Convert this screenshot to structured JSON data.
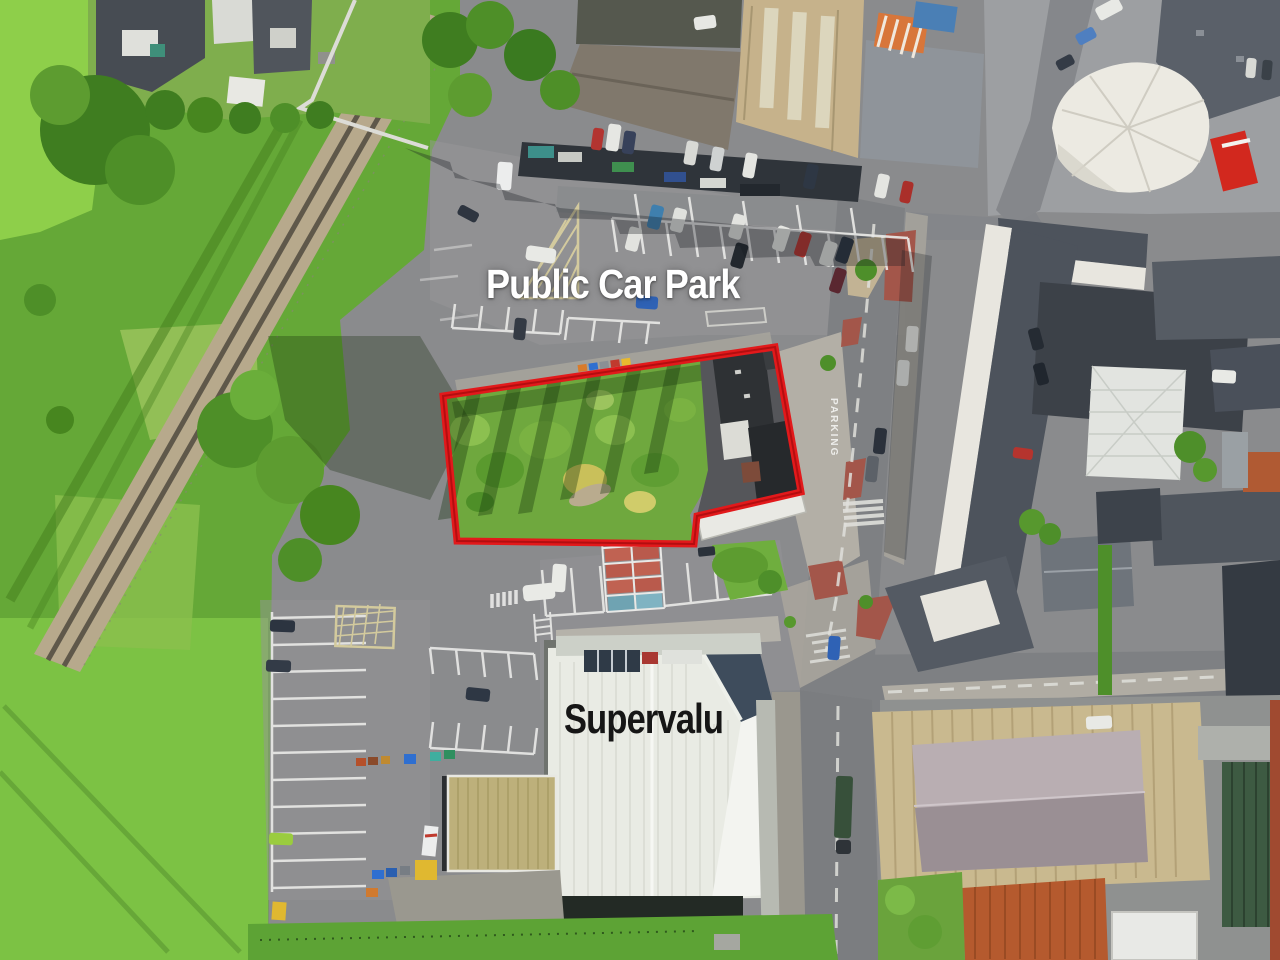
{
  "image": {
    "kind": "aerial-drone-photograph",
    "width_px": 1280,
    "height_px": 960
  },
  "annotations": {
    "car_park_label": {
      "text": "Public Car Park",
      "color": "#ffffff"
    },
    "supermarket_label": {
      "text": "Supervalu",
      "color": "#161616"
    },
    "road_marking_label": {
      "text": "PARKING",
      "color": "#f2f2f0"
    },
    "site_boundary": {
      "color": "#e2191b",
      "inner_color": "#b30e10",
      "points": "443,396 775,347 801,492 697,516 694,544 457,541"
    }
  },
  "palette": {
    "asphalt": "#8a8b8d",
    "road": "#7e8083",
    "grass": "#65a837",
    "bright_grass": "#84c24a",
    "site_vegetation": "#6fa83e",
    "rail_gravel": "#b7a98c",
    "roof_slate": "#4d535c",
    "roof_white": "#eaece5",
    "roof_tan": "#c6b28b",
    "roof_rust": "#b55a2e",
    "red_paving": "#a3564a",
    "painted_bay_red": "#b95a4c",
    "painted_bay_teal": "#6fa3b2"
  }
}
